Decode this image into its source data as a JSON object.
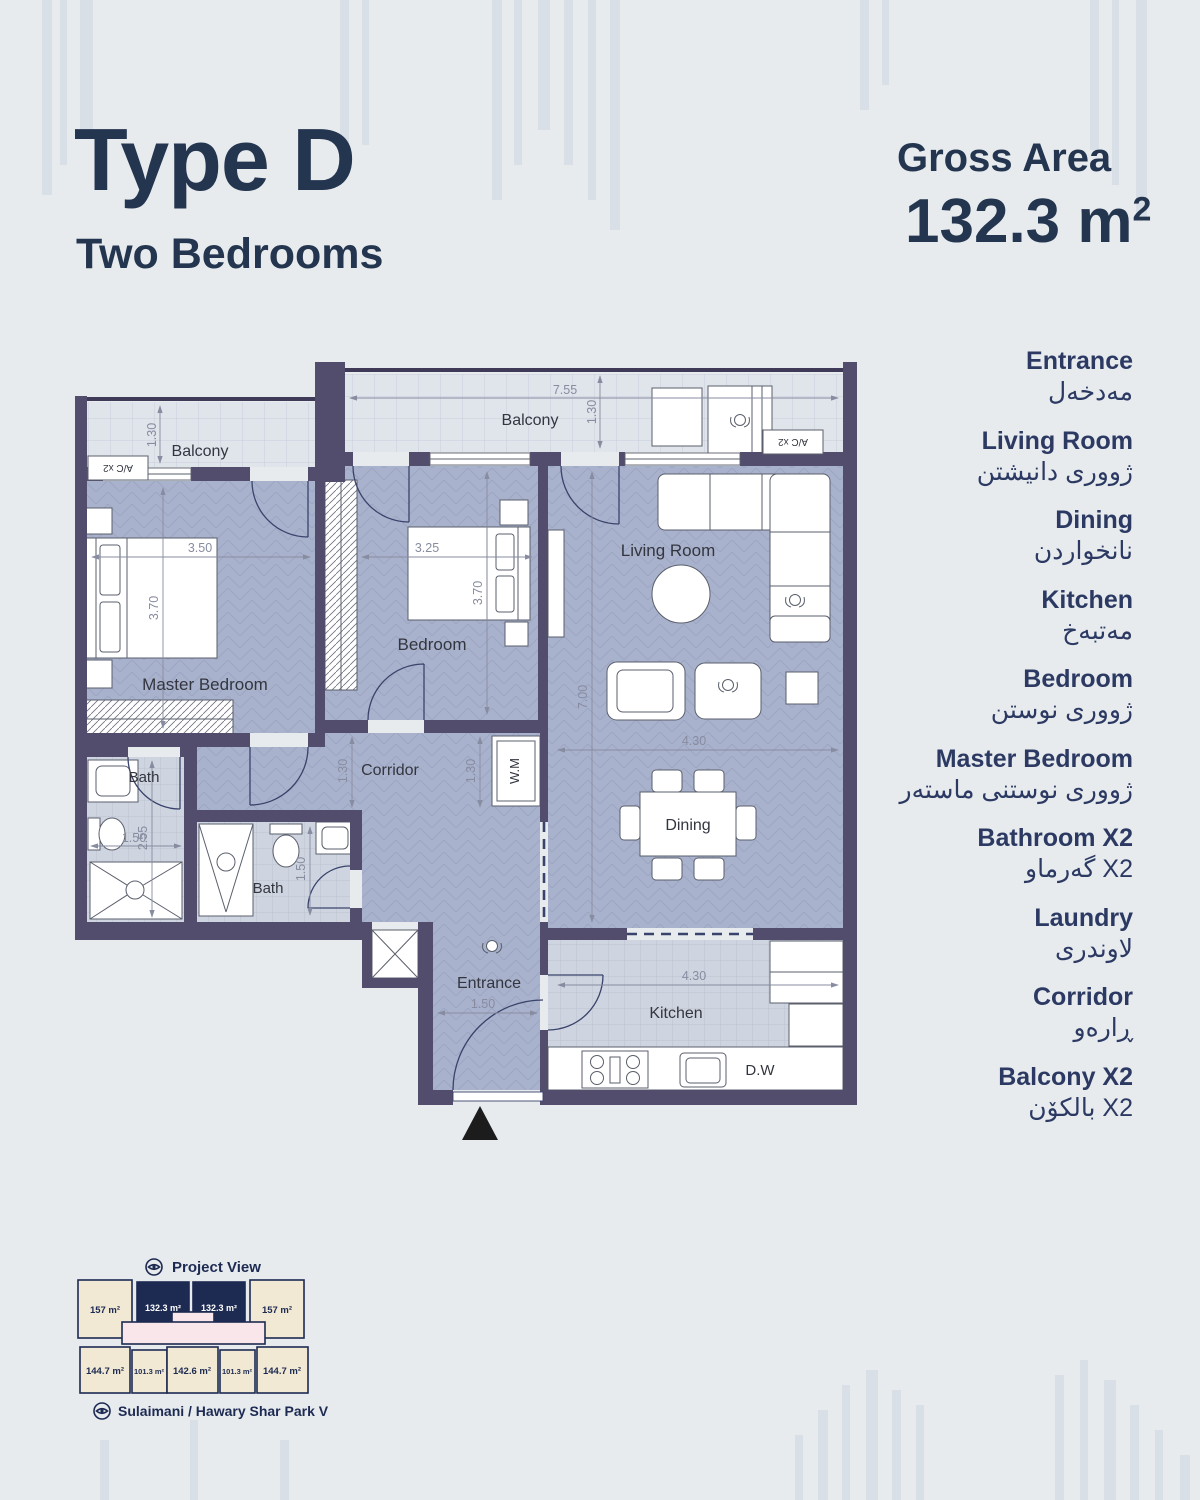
{
  "page": {
    "title": "Type D",
    "subtitle": "Two Bedrooms",
    "gross_area_label": "Gross Area",
    "gross_area_value": "132.3 m",
    "gross_area_sup": "2"
  },
  "legend": [
    {
      "en": "Entrance",
      "ku": "مەدخەل"
    },
    {
      "en": "Living Room",
      "ku": "ژووری دانیشتن"
    },
    {
      "en": "Dining",
      "ku": "نانخواردن"
    },
    {
      "en": "Kitchen",
      "ku": "مەتبەخ"
    },
    {
      "en": "Bedroom",
      "ku": "ژووری نوستن"
    },
    {
      "en": "Master Bedroom",
      "ku": "ژووری نوستنی ماستەر"
    },
    {
      "en": "Bathroom X2",
      "ku": "گەرماو X2"
    },
    {
      "en": "Laundry",
      "ku": "لاوندری"
    },
    {
      "en": "Corridor",
      "ku": "ڕارەو"
    },
    {
      "en": "Balcony X2",
      "ku": "بالکۆن X2"
    }
  ],
  "plan": {
    "labels": {
      "balcony_left": "Balcony",
      "balcony_top": "Balcony",
      "master": "Master Bedroom",
      "bedroom": "Bedroom",
      "living": "Living Room",
      "dining": "Dining",
      "kitchen": "Kitchen",
      "entrance": "Entrance",
      "corridor": "Corridor",
      "bath_a": "Bath",
      "bath_b": "Bath",
      "wm": "W.M",
      "dw": "D.W",
      "ac_left": "A/C x2",
      "ac_right": "A/C x2"
    },
    "dims": {
      "balcony_w": "7.55",
      "balcony_h": "1.30",
      "balcony_left_h": "1.30",
      "master_w": "3.50",
      "master_h": "3.70",
      "bedroom_w": "3.25",
      "bedroom_h": "3.70",
      "living_h": "7.00",
      "living_w": "4.30",
      "kitchen_w": "4.30",
      "bath_a_w": "1.50",
      "bath_a_h": "2.55",
      "bath_b_h": "1.50",
      "corridor_h1": "1.30",
      "corridor_h2": "1.30",
      "entrance_w": "1.50"
    }
  },
  "minimap": {
    "project_view": "Project View",
    "park_view": "Sulaimani / Hawary Shar Park View",
    "top_units": [
      "157 m²",
      "132.3 m²",
      "132.3 m²",
      "157 m²"
    ],
    "bottom_units": [
      "144.7 m²",
      "101.3 m²",
      "142.6 m²",
      "101.3 m²",
      "144.7 m²"
    ]
  },
  "colors": {
    "navy": "#24354f",
    "legend_navy": "#2c3a63",
    "wall": "#524d6d",
    "floor": "#a9b2cc",
    "balcony_floor": "#e0e4eb",
    "bath_floor": "#cfd5e0",
    "unit_cream": "#f1e9d3",
    "unit_highlight": "#1d2a52",
    "dim": "#878ca0"
  }
}
